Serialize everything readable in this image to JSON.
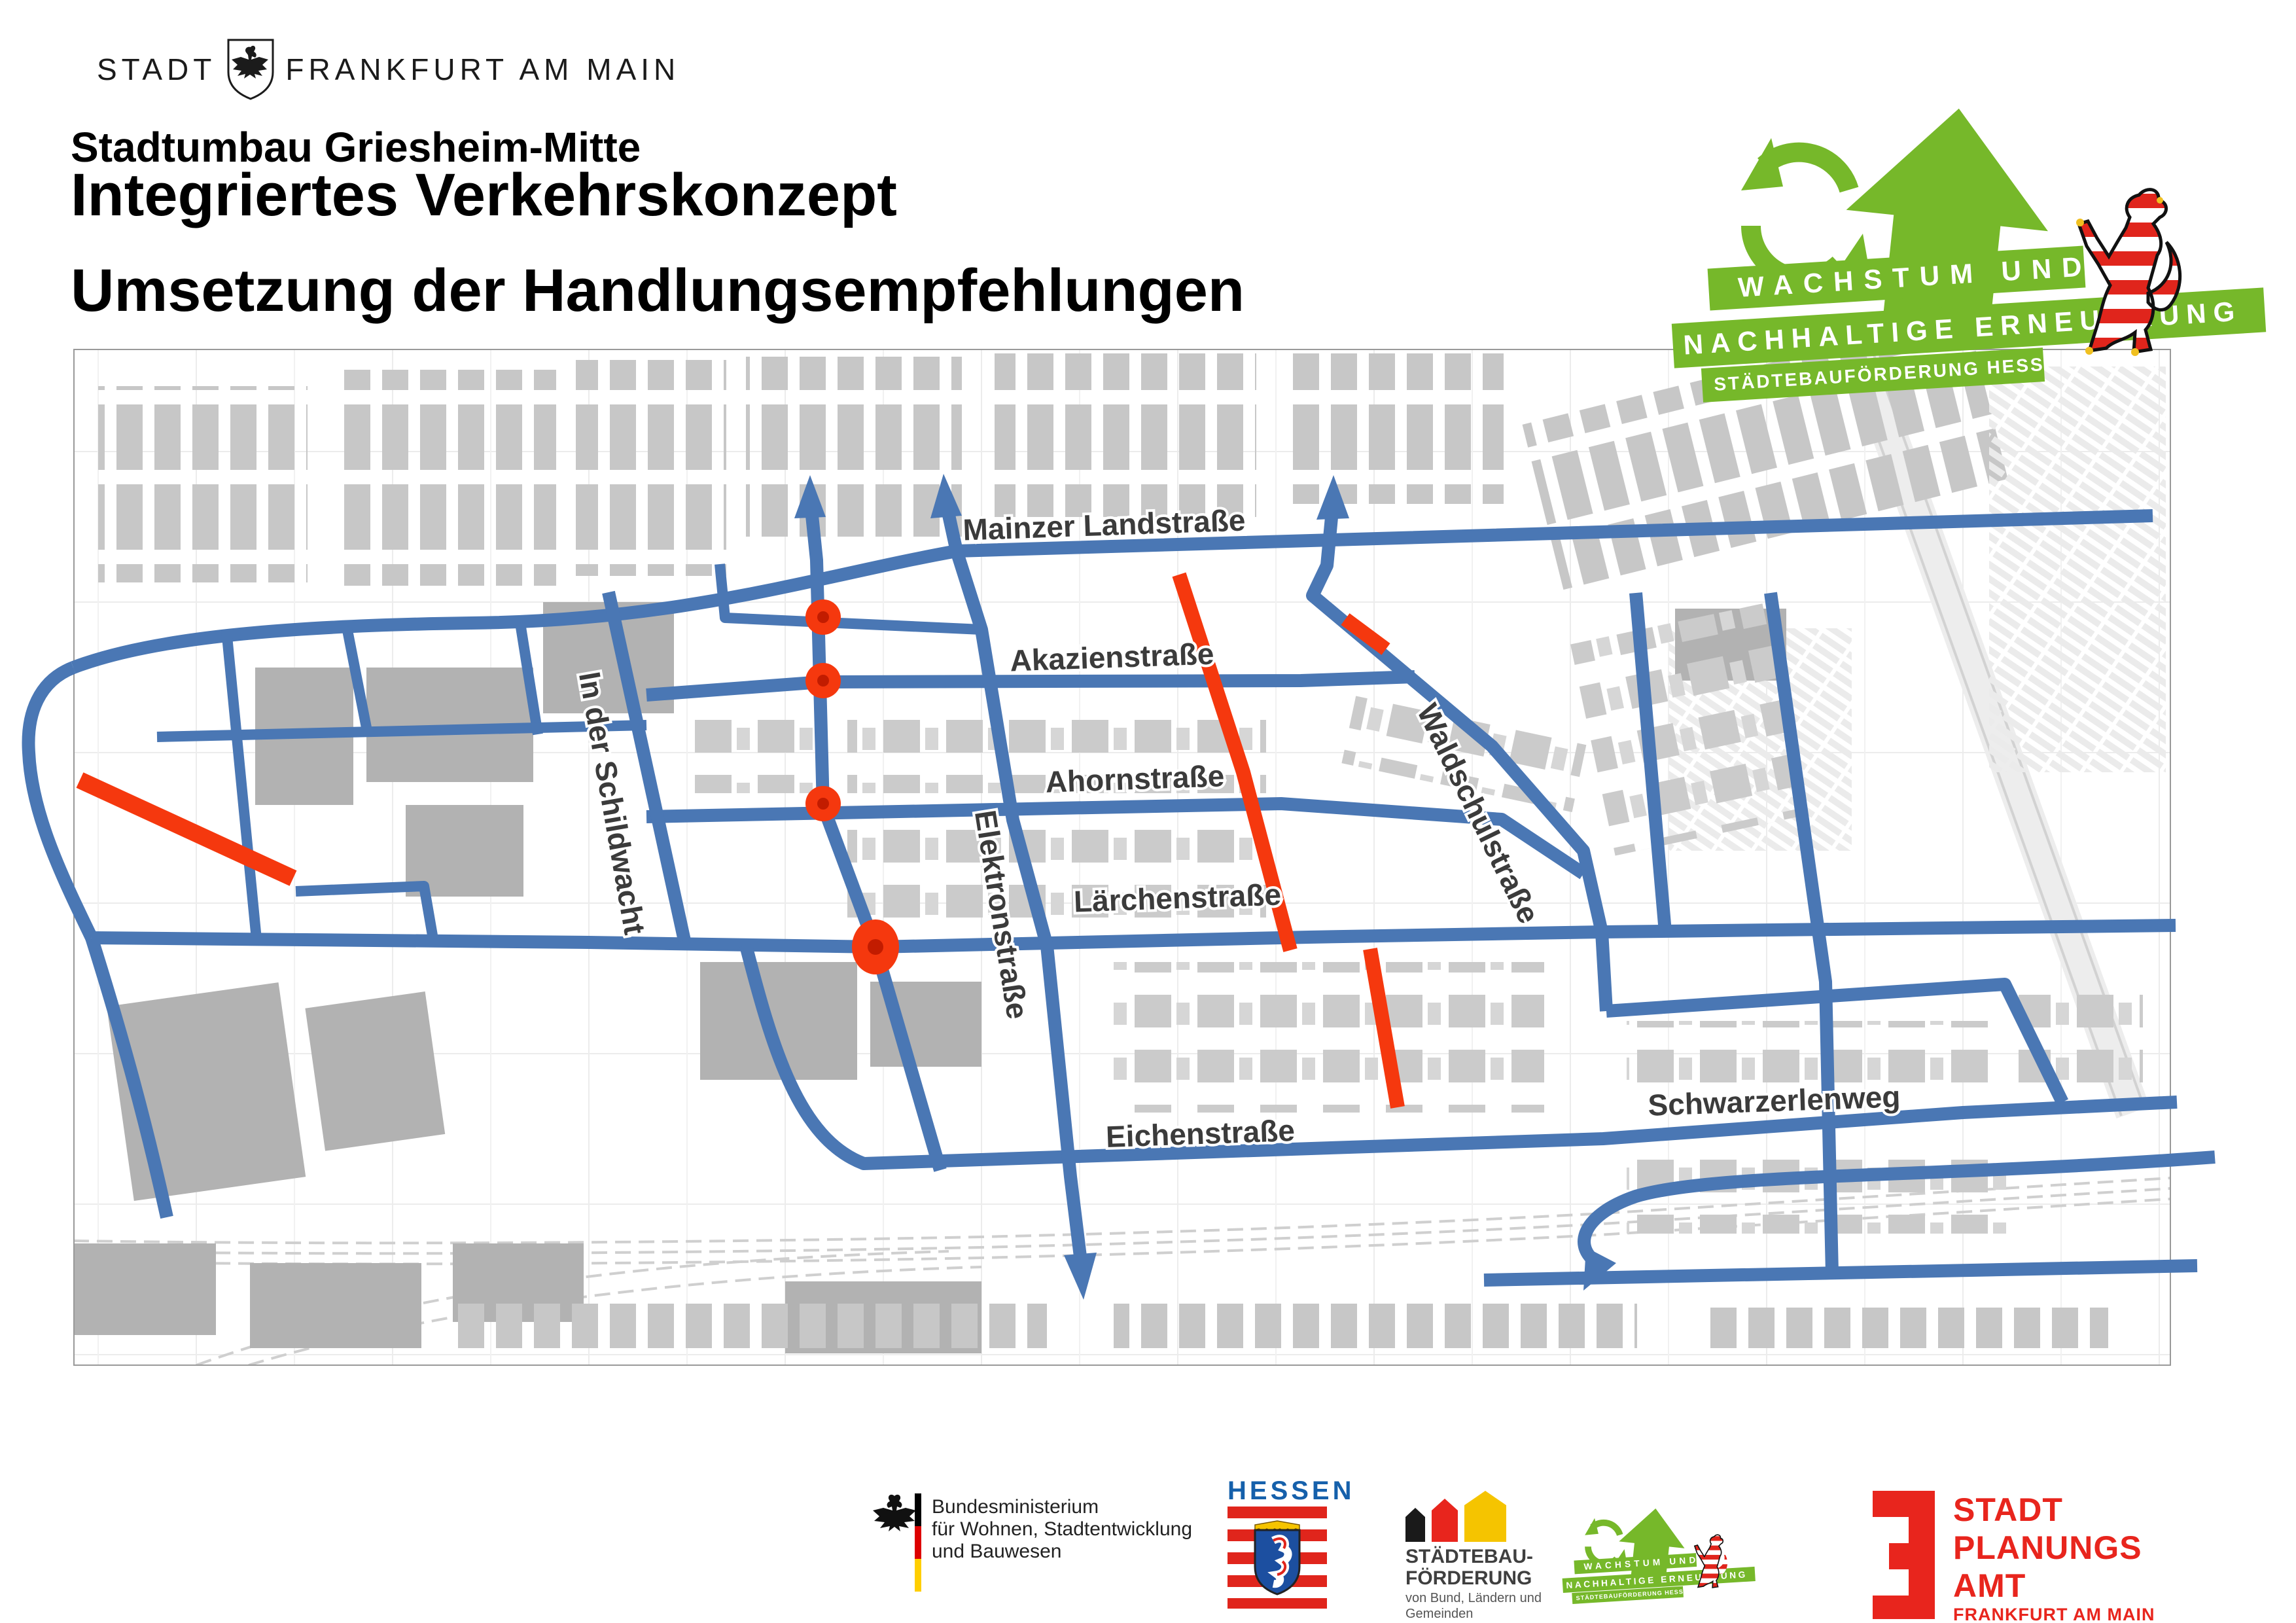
{
  "city_logo": {
    "stadt": "Stadt",
    "name": "Frankfurt am Main"
  },
  "header": {
    "title_line1": "Stadtumbau Griesheim-Mitte",
    "title_line2": "Integriertes Verkehrskonzept",
    "subtitle": "Umsetzung der Handlungsempfehlungen"
  },
  "growth_logo": {
    "banner1": "WACHSTUM UND",
    "banner2": "NACHHALTIGE ERNEUERUNG",
    "banner3": "STÄDTEBAUFÖRDERUNG HESSEN"
  },
  "map": {
    "streets": {
      "mainzer": "Mainzer Landstraße",
      "akazien": "Akazienstraße",
      "ahorn": "Ahornstraße",
      "laerchen": "Lärchenstraße",
      "eichen": "Eichenstraße",
      "schwarzerlen": "Schwarzerlenweg",
      "schildwacht": "In der Schildwacht",
      "elektron": "Elektronstraße",
      "waldschul": "Waldschulstraße"
    },
    "colors": {
      "road_network": "#4a77b4",
      "measure_red": "#f5380e",
      "building_gray": "#c9c9c9"
    }
  },
  "footer": {
    "bund": {
      "line1": "Bundesministerium",
      "line2": "für Wohnen, Stadtentwicklung",
      "line3": "und Bauwesen"
    },
    "hessen": {
      "title": "HESSEN"
    },
    "staedtebau": {
      "line1": "STÄDTEBAU-",
      "line2": "FÖRDERUNG",
      "line3": "von Bund, Ländern und",
      "line4": "Gemeinden"
    },
    "stadtplanungsamt": {
      "line1": "STADT",
      "line2": "PLANUNGS",
      "line3": "AMT",
      "line4": "FRANKFURT AM MAIN"
    }
  }
}
